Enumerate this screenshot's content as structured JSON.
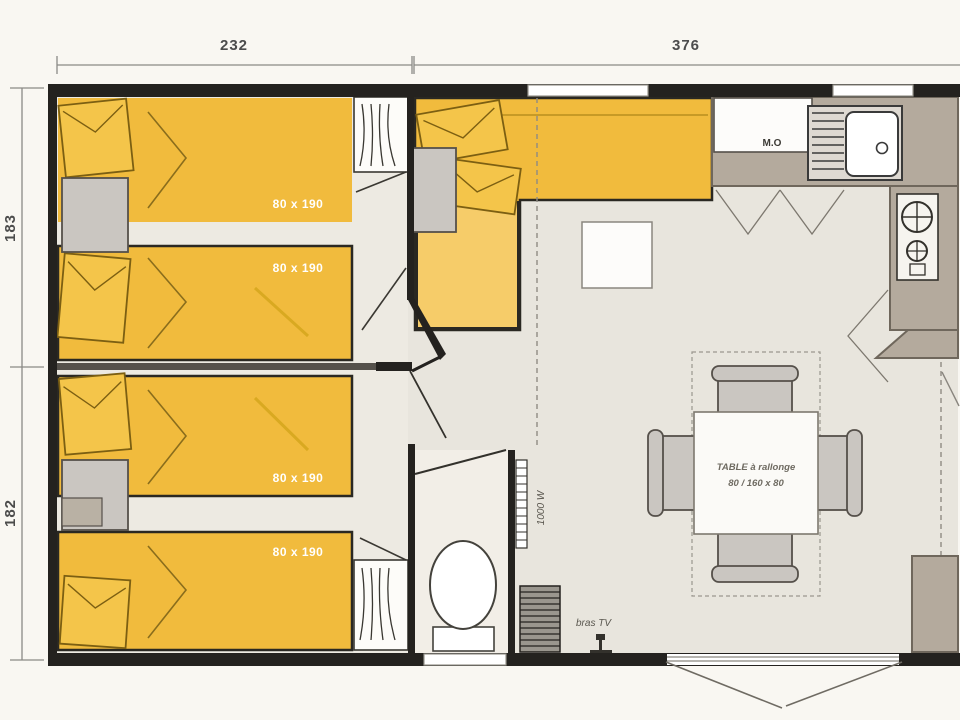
{
  "dimensions": {
    "top_left": "232",
    "top_right": "376",
    "left_upper": "183",
    "left_lower": "182"
  },
  "beds": [
    {
      "label": "80 x 190"
    },
    {
      "label": "80 x 190"
    },
    {
      "label": "80 x 190"
    },
    {
      "label": "80 x 190"
    }
  ],
  "kitchen": {
    "microwave_label": "M.O"
  },
  "dining": {
    "table_label_line1": "TABLE à rallonge",
    "table_label_line2": "80 / 160 x 80"
  },
  "living": {
    "tv_bracket_label": "bras TV"
  },
  "wc": {
    "heater_label": "1000 W"
  },
  "colors": {
    "paper": "#f9f7f2",
    "floor": "#e8e5dd",
    "bedroom_floor": "#edeae2",
    "wc_floor": "#f2eee7",
    "wall_dark": "#24221f",
    "bed_yellow": "#f1bb3d",
    "chaise_yellow": "#f6cc69",
    "pillow_yellow": "#f4c54a",
    "counter_taupe": "#b4aa9d",
    "furniture_gray": "#cac6c1",
    "white": "#fdfcf9"
  }
}
